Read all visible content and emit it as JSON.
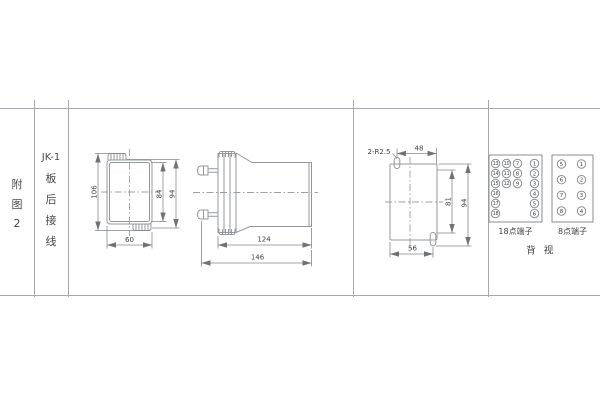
{
  "page": {
    "background": "#ffffff"
  },
  "colors": {
    "line": "#94989c",
    "text": "#3f4245",
    "table_line": "#a6aaae"
  },
  "table": {
    "figure_label_lines": [
      "附",
      "图",
      "2"
    ],
    "spec_label_lines": [
      "JK-1",
      "板",
      "后",
      "接",
      "线"
    ]
  },
  "views": {
    "front": {
      "dim_height_overall": "106",
      "dim_height_inner": "84",
      "dim_height_body": "94",
      "dim_width": "60"
    },
    "side": {
      "dim_length_body": "124",
      "dim_length_overall": "146"
    },
    "cutout": {
      "note_radius": "2-R2.5",
      "dim_width_top": "48",
      "dim_height_inner": "81",
      "dim_height_overall": "94",
      "dim_width_bottom": "56"
    }
  },
  "terminals": {
    "box18": {
      "caption": "18点端子",
      "col1": [
        "13",
        "14",
        "15",
        "16",
        "17",
        "18"
      ],
      "col2": [
        "10",
        "11",
        "12"
      ],
      "col3": [
        "7",
        "8",
        "9"
      ],
      "col4": [
        "1",
        "2",
        "3",
        "4",
        "5",
        "6"
      ]
    },
    "box8": {
      "caption": "8点端子",
      "col1": [
        "5",
        "6",
        "7",
        "8"
      ],
      "col2": [
        "1",
        "2",
        "3",
        "4"
      ]
    },
    "rear_view_label": "背 视"
  }
}
